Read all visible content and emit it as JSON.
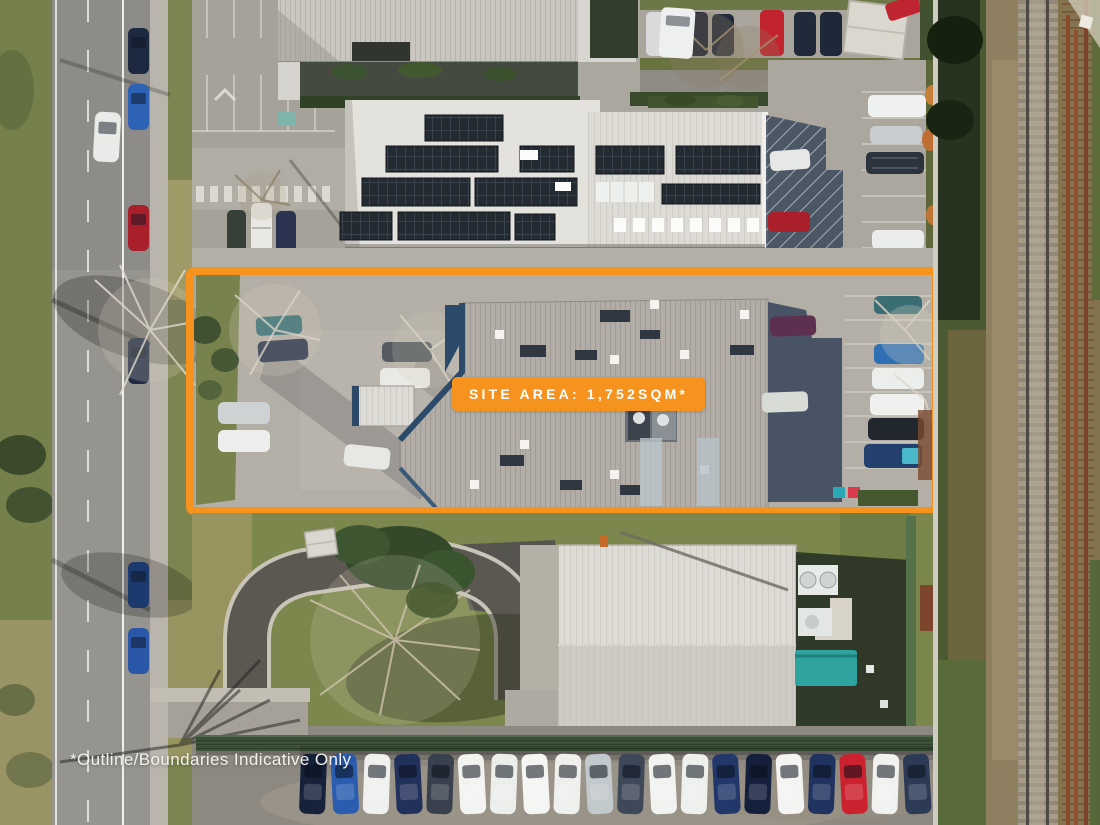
{
  "overlay": {
    "site_area_label": "SITE AREA: 1,752SQM*",
    "disclaimer": "*Outline/Boundaries Indicative Only",
    "accent_color": "#F6921E"
  },
  "scene": {
    "type": "aerial-drone-photograph",
    "subject": "Commercial property outlined with orange site boundary, neighbouring office building with rooftop solar panels, rear yard with shed, street parking and railway corridor",
    "boundary": {
      "color": "#F6921E",
      "shape": "rectangle"
    },
    "bottom_parking_row": {
      "car_colors": [
        "#16213a",
        "#2a5cb0",
        "#f0f1ef",
        "#22315c",
        "#39414e",
        "#f3f3f1",
        "#eceeec",
        "#f5f5f3",
        "#eff0ee",
        "#c2c8cc",
        "#3f4859",
        "#f2f2f0",
        "#eef0ed",
        "#22386a",
        "#15203c",
        "#f4f4f2",
        "#1f3260",
        "#cc2230",
        "#f1f2f0",
        "#2c3a55"
      ]
    },
    "left_street_cars": [
      {
        "y": 28,
        "color": "#1c2940"
      },
      {
        "y": 84,
        "color": "#2e62b4"
      },
      {
        "y": 205,
        "color": "#aa1f2c"
      },
      {
        "y": 338,
        "color": "#202c44"
      },
      {
        "y": 562,
        "color": "#1d3a6e"
      },
      {
        "y": 628,
        "color": "#2a57a8"
      }
    ]
  }
}
